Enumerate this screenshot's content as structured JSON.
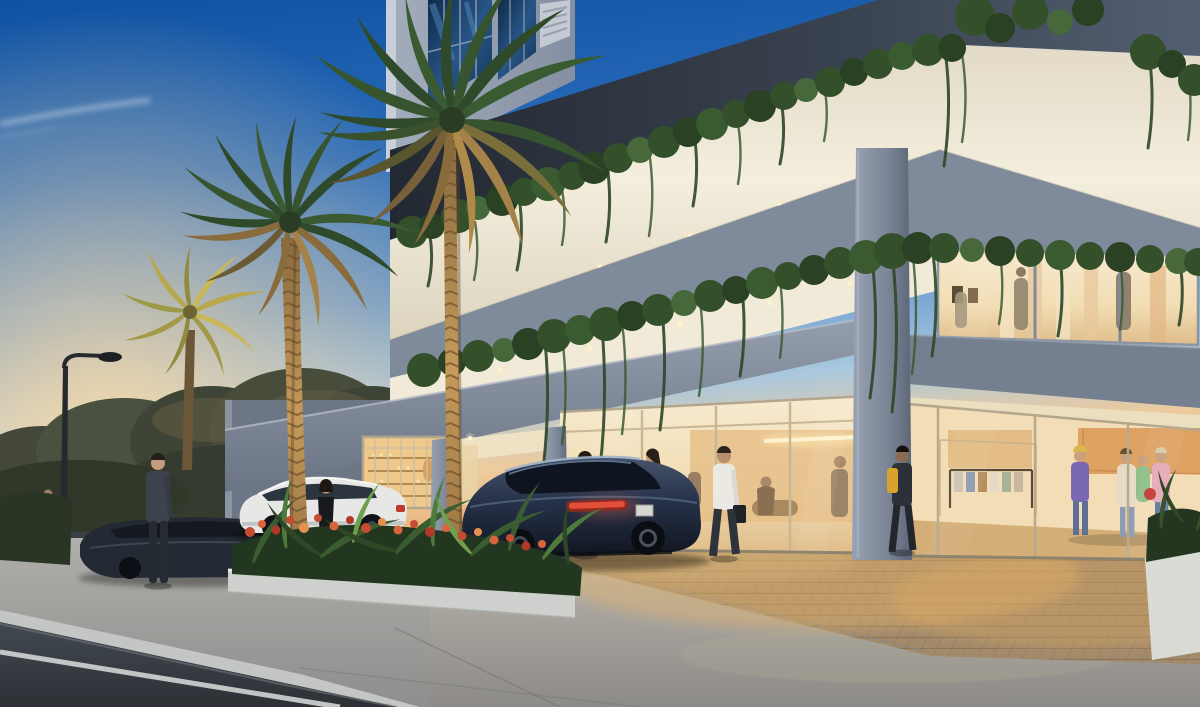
{
  "scene": {
    "title": "Residential tower entrance at dusk",
    "type": "architectural rendering",
    "time_of_day": "dusk",
    "sky": "deep blue sky with jet contrail and warm sunset glow at the horizon",
    "setting": "modern condominium podium with porte-cochere driveway, glowing retail storefronts, trailing balcony vines and palm trees"
  },
  "palette": {
    "sky_top": "#1155a5",
    "sky_mid": "#4e86c6",
    "sunset_glow": "#f6cd9a",
    "facade_grey": "#8e99aa",
    "soffit_dark": "#2a313c",
    "lit_band": "#f2ecdc",
    "vine_green": "#33502b",
    "canopy_grey": "#7d8695",
    "interior_warm": "#f3e0bd",
    "interior_orange": "#d8954f",
    "paver_tan": "#a28a6b",
    "concrete": "#b3b0a9",
    "asphalt": "#3d4248",
    "planter_white": "#d4d6d2",
    "flower_red": "#c64b31",
    "palm_green": "#2f4a2a",
    "palm_gold": "#b08a48",
    "sedan_navy": "#232d3e",
    "suv_white": "#e7e8e6",
    "taillight_red": "#e2503a"
  },
  "building": {
    "tower": "grey concrete tower with blue reflective glass windows and a louvre vent grille",
    "upper_soffit": "dark shadowed soffit band beneath the tower",
    "lit_band_1": "illuminated white balcony soffit with recessed downlights",
    "lit_band_2": "second illuminated soffit over the entrance canopy",
    "canopy": "concrete porte-cochere beam with recessed downlights",
    "vines": "trailing green vines draped over every balcony parapet",
    "columns": "three grey concrete columns supporting the canopy"
  },
  "storefronts": {
    "market": "warm-lit market with shelving of bottles and goods",
    "lobby": "double-height glass lobby with linear pendant light and seated guests",
    "boutique": "clothing boutique with racks, shoppers and orange feature wall",
    "showroom": "second-floor warm-lit showroom with figures among displays"
  },
  "vehicles": {
    "sedan": "dark navy luxury sedan waiting at the entrance, tail lights lit",
    "suv": "white crossover parked at the kerb",
    "parked_car": "dark grey car parked on the street"
  },
  "people": {
    "man_in_suit": "man in dark suit standing by the street",
    "woman_black_dress": "woman in black dress walking on the sidewalk",
    "valet": "valet in white jacket beside the sedan",
    "lobby_visitor": "woman with ponytail near the lobby doors",
    "man_white_shirt": "man in white shirt carrying a bag toward the lobby",
    "backpack_man": "man in dark clothes with yellow backpack by the boutique",
    "distant_pedestrian": "distant pedestrian on the far sidewalk",
    "shoppers": "four shoppers browsing inside the boutique",
    "showroom_figures": "figures visible in the second-floor showroom",
    "lobby_guests": "guests seated inside the lobby"
  },
  "landscape": {
    "palms": "two tall uplit palm trees and one small golden palm",
    "hedge": "white planter with ferns and red-orange flowering shrubs",
    "street_trees": "leafy trees silhouetted against the sunset",
    "street_lamp": "curved street lamp, unlit",
    "right_planter": "white planter with dark foliage at lower right"
  },
  "ground": {
    "driveway": "tan brick paver court washed in warm light",
    "apron": "smooth concrete apron with expansion joints",
    "road": "dark asphalt street with white edge line and kerb"
  }
}
